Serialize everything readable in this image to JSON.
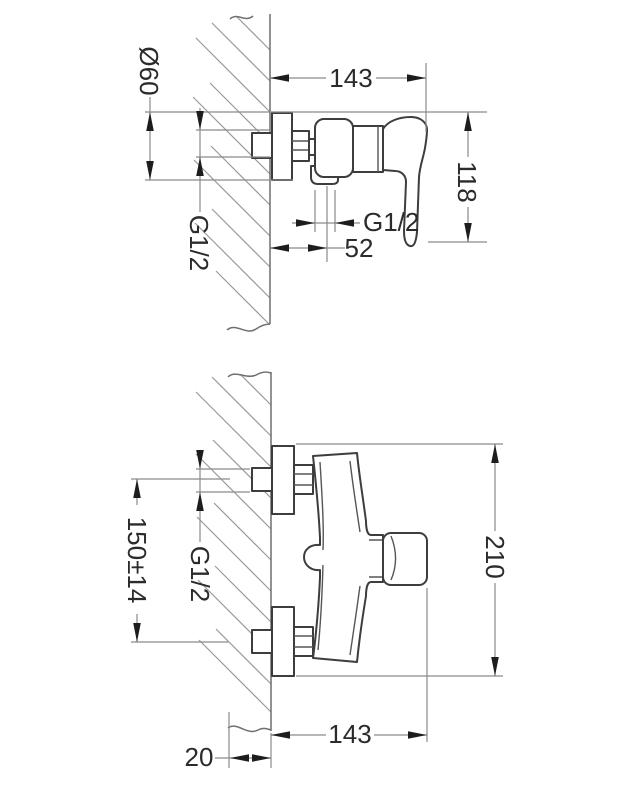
{
  "page": {
    "title": "Wall-mounted shower mixer installation dimensions"
  },
  "colors": {
    "paper": "#ffffff",
    "ink": "#2b2b2b",
    "dimension_lines": "#8a8a8a"
  },
  "side_view": {
    "labels": {
      "depth": "143",
      "height": "118",
      "flange_diameter": "Ø60",
      "inlet_thread": "G1/2",
      "outlet_thread": "G1/2",
      "outlet_offset": "52"
    }
  },
  "plan_view": {
    "labels": {
      "connection_spacing": "150±14",
      "supply_thread": "G1/2",
      "overall_length": "210",
      "depth": "143",
      "wall_recess": "20"
    }
  }
}
